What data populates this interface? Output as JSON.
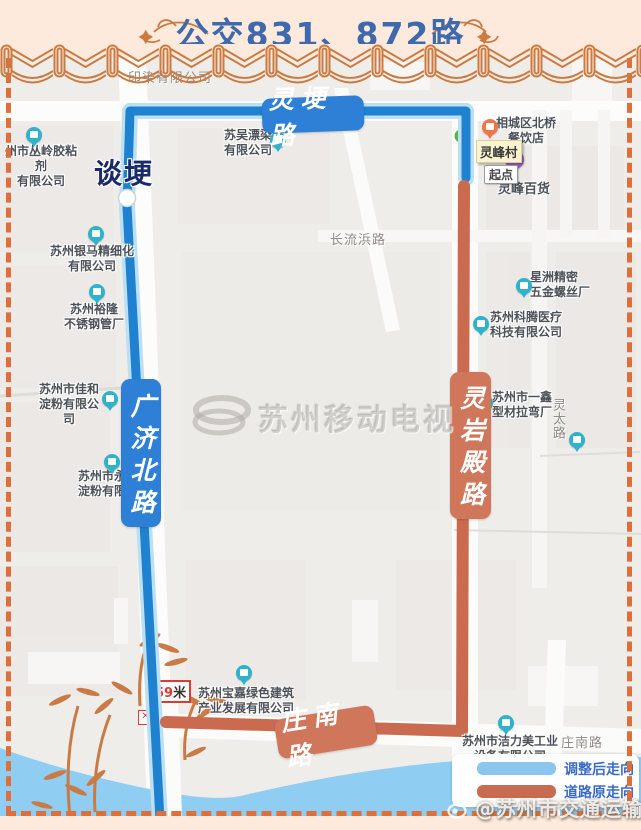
{
  "title": "公交831、872路",
  "legend": {
    "adjusted": "调整后走向",
    "original": "道路原走向",
    "adjusted_color": "#8ac6ee",
    "original_color": "#c76b51"
  },
  "credit": "@苏州市交通运输局",
  "center_watermark": "苏州移动电视",
  "route_labels": {
    "linggeng": "灵埂路",
    "guangjibei": "广济北路",
    "lingyandian": "灵岩殿路",
    "zhuangnan": "庄南路"
  },
  "stops": {
    "tangeng": "谈埂",
    "lingfengcun": "灵峰村",
    "qidian": "起点",
    "distance_num": "59",
    "distance_unit": "米"
  },
  "road_texts": {
    "yinran": "印染有限公司",
    "changliubang": "长流浜路",
    "lingtai": "灵太路",
    "zhuangnan_right": "庄南路",
    "lingfeng_store": "灵峰百货"
  },
  "pois": [
    {
      "lines": [
        "州市丛岭胶粘剂",
        "有限公司"
      ]
    },
    {
      "lines": [
        "苏吴漂染",
        "有限公司"
      ]
    },
    {
      "lines": [
        "苏州银马精细化",
        "有限公司"
      ]
    },
    {
      "lines": [
        "苏州裕隆",
        "不锈钢管厂"
      ]
    },
    {
      "lines": [
        "苏州市佳和",
        "淀粉有限公司"
      ]
    },
    {
      "lines": [
        "苏州市永",
        "淀粉有限公"
      ]
    },
    {
      "lines": [
        "星洲精密",
        "五金螺丝厂"
      ]
    },
    {
      "lines": [
        "苏州科腾医疗",
        "科技有限公司"
      ]
    },
    {
      "lines": [
        "苏州市一鑫",
        "型材拉弯厂"
      ]
    },
    {
      "lines": [
        "苏州宝嘉绿色建筑",
        "产业发展有限公司"
      ]
    },
    {
      "lines": [
        "苏州市洁力美工业",
        "设备有限公司"
      ]
    },
    {
      "lines": [
        "相城区北桥",
        "餐饮店"
      ]
    }
  ],
  "colors": {
    "route_adjusted": "#1e82d0",
    "route_original": "#ca6b50",
    "map_bg": "#efedea",
    "water": "#8fcdf3",
    "border_orange": "#df6f3a",
    "banner_bg": "#fdeadc",
    "title_color": "#3f69ad"
  }
}
